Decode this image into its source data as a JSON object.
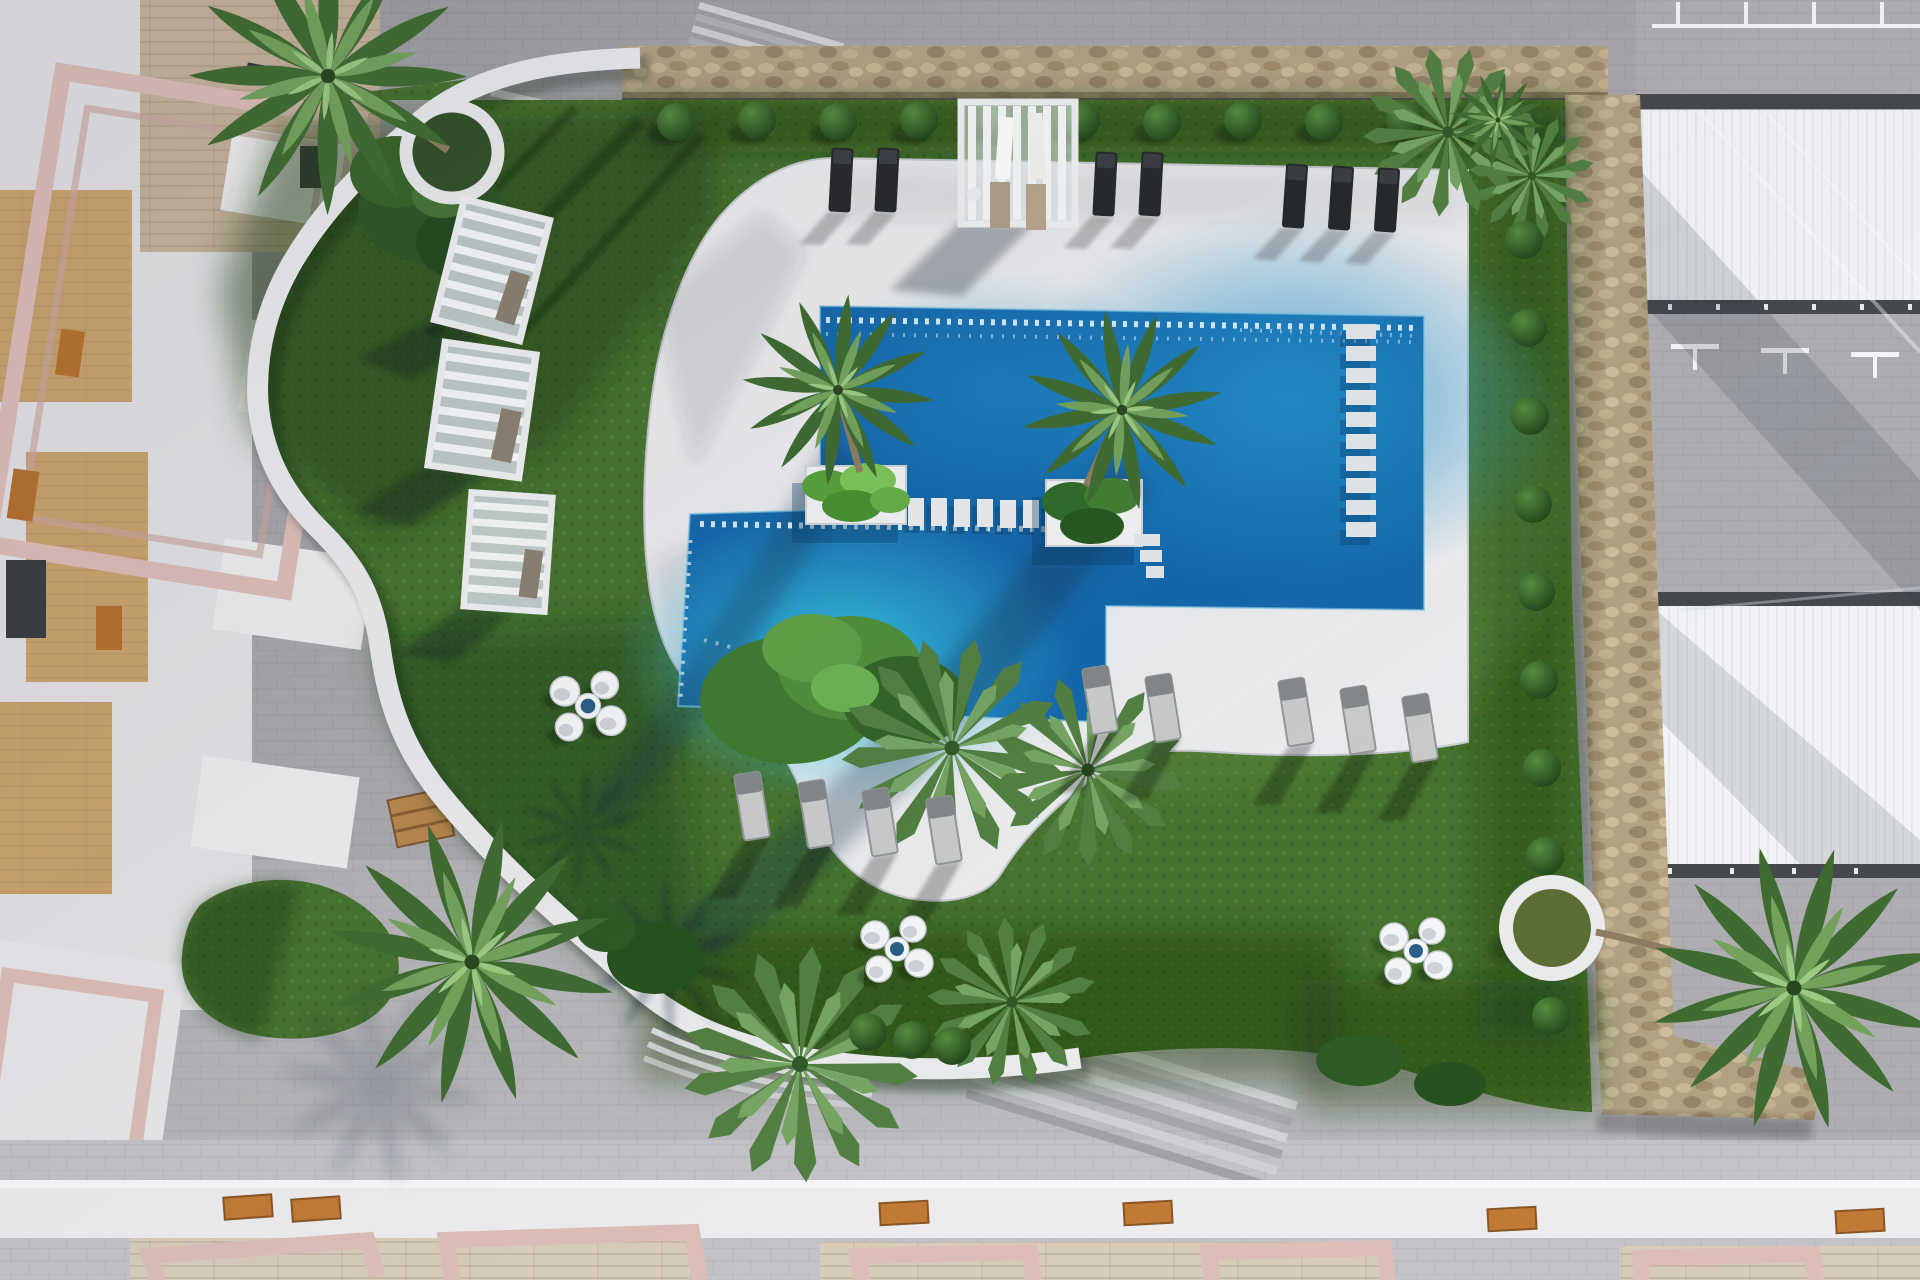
{
  "scene": {
    "type": "aerial-3d-architectural-render",
    "description": "Top-down 3D rendering of a residential resort courtyard: two connected rectangular swimming pools on a white sun deck, surrounded by an organic green lawn, curved white garden walls, natural stone perimeter walls, palm trees, hedge balls, slatted white cabanas, sun loungers and round lounge-chair clusters, framed by apartment buildings with pink pergolas and white roofs.",
    "time_of_day": "sunny midday, long shadows toward lower-left"
  },
  "colors": {
    "pavement": "#b5b5b9",
    "pavement_dark": "#a6a6ab",
    "pavement_light": "#c7c7cb",
    "deck": "#eaebed",
    "pool": "#1568ab",
    "pool_bright": "#35bede",
    "pool_sparkle": "#e8f7fd",
    "grass": "#47732f",
    "grass_dark": "#27511f",
    "grass_light": "#5c8f42",
    "stone": "#b2a284",
    "white_wall": "#e9eaec",
    "pink_pergola": "#dcbdb7",
    "wood": "#b9874f",
    "wood_floor": "#c9a36e",
    "travertine": "#d7cbba",
    "cabana_fill": "#cdd5da",
    "lounger_dark": "#26292c",
    "lounger_gray": "#c9cbcb",
    "table_top": "#2b5f86",
    "bush": "#2f5b27",
    "palm": "#6f9e58",
    "roof_white": "#f2f3f5",
    "beam_dark": "#45484d"
  },
  "inventory": {
    "pools": 2,
    "pool_palm_islands": 2,
    "stepping_piers": 7,
    "in_pool_steps": 10,
    "cabanas_left": 3,
    "cabanas_top": 1,
    "dark_loungers_top": 7,
    "gray_loungers_center": 4,
    "gray_loungers_right": 5,
    "pod_chair_clusters": 3,
    "pod_chairs_per_cluster": 4,
    "hedge_balls_top": 11,
    "hedge_balls_right": 10,
    "circular_planters": 3,
    "wooden_benches": 2,
    "wooden_gates": 6,
    "pink_pergola_frames_bottom": 5,
    "large_palms": 6
  }
}
